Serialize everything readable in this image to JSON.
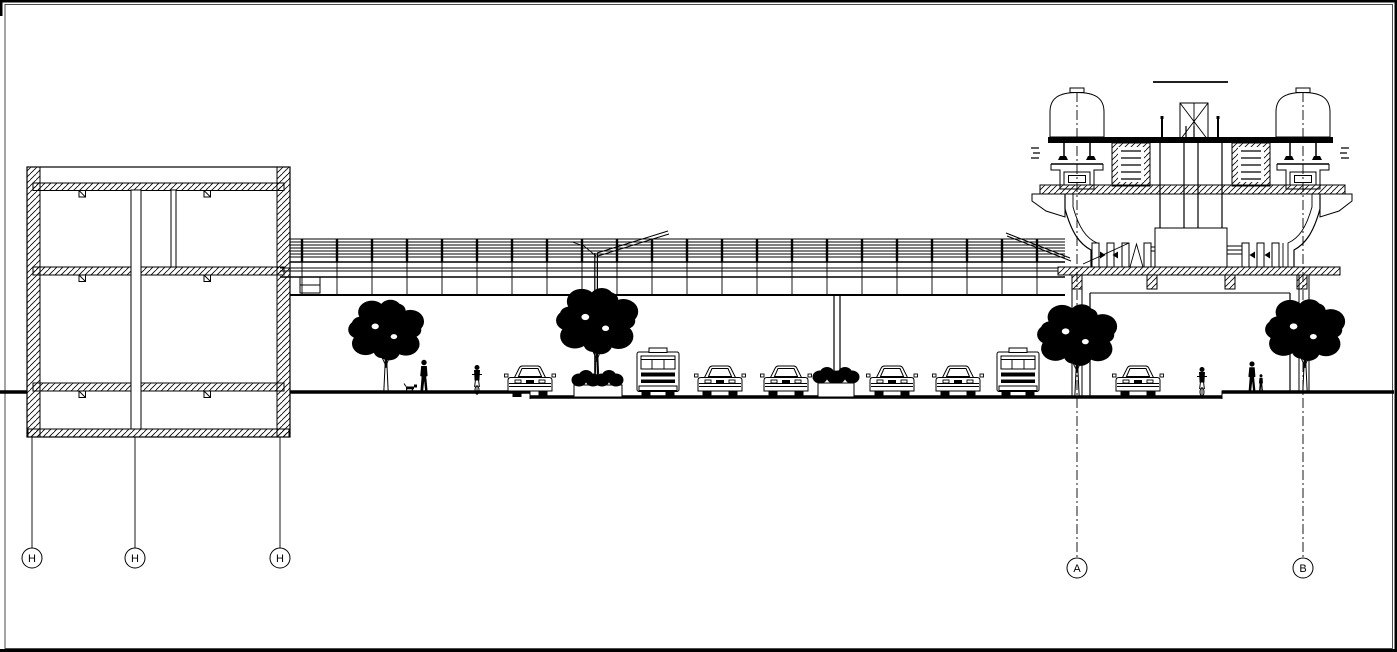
{
  "drawing": {
    "background": "#ffffff",
    "ink": "#000000",
    "kind": "cad-section-elevation"
  },
  "grid_markers": [
    {
      "label": "H",
      "x": 32,
      "bubble_cy": 558,
      "line_top": 437,
      "line_style": "solid"
    },
    {
      "label": "H",
      "x": 135,
      "bubble_cy": 558,
      "line_top": 437,
      "line_style": "solid"
    },
    {
      "label": "H",
      "x": 280,
      "bubble_cy": 558,
      "line_top": 437,
      "line_style": "solid"
    },
    {
      "label": "A",
      "x": 1077,
      "bubble_cy": 568,
      "line_top": 92,
      "line_style": "dashdot"
    },
    {
      "label": "B",
      "x": 1303,
      "bubble_cy": 568,
      "line_top": 92,
      "line_style": "dashdot"
    }
  ],
  "trees": [
    {
      "x": 386,
      "base_y": 392,
      "rx": 36,
      "ry": 30
    },
    {
      "x": 597,
      "base_y": 386,
      "rx": 39,
      "ry": 33
    },
    {
      "x": 1077,
      "base_y": 397,
      "rx": 38,
      "ry": 30
    },
    {
      "x": 1305,
      "base_y": 392,
      "rx": 38,
      "ry": 30
    }
  ],
  "vehicles": [
    {
      "type": "car",
      "x": 530,
      "ground_y": 397
    },
    {
      "type": "bus",
      "x": 658,
      "ground_y": 397
    },
    {
      "type": "car",
      "x": 720,
      "ground_y": 397
    },
    {
      "type": "car",
      "x": 786,
      "ground_y": 397
    },
    {
      "type": "car",
      "x": 892,
      "ground_y": 397
    },
    {
      "type": "car",
      "x": 958,
      "ground_y": 397
    },
    {
      "type": "bus",
      "x": 1018,
      "ground_y": 397
    },
    {
      "type": "car",
      "x": 1138,
      "ground_y": 397
    }
  ],
  "people": [
    {
      "type": "walker",
      "x": 424,
      "ground_y": 392
    },
    {
      "type": "dog",
      "x": 411,
      "ground_y": 392
    },
    {
      "type": "cyclist",
      "x": 477,
      "ground_y": 394
    },
    {
      "type": "cyclist",
      "x": 1202,
      "ground_y": 396
    },
    {
      "type": "adult_with_child",
      "x": 1252,
      "ground_y": 392
    }
  ],
  "bushes": [
    {
      "x": 586,
      "y": 385
    },
    {
      "x": 609,
      "y": 385
    },
    {
      "x": 827,
      "y": 382
    },
    {
      "x": 845,
      "y": 382
    }
  ]
}
